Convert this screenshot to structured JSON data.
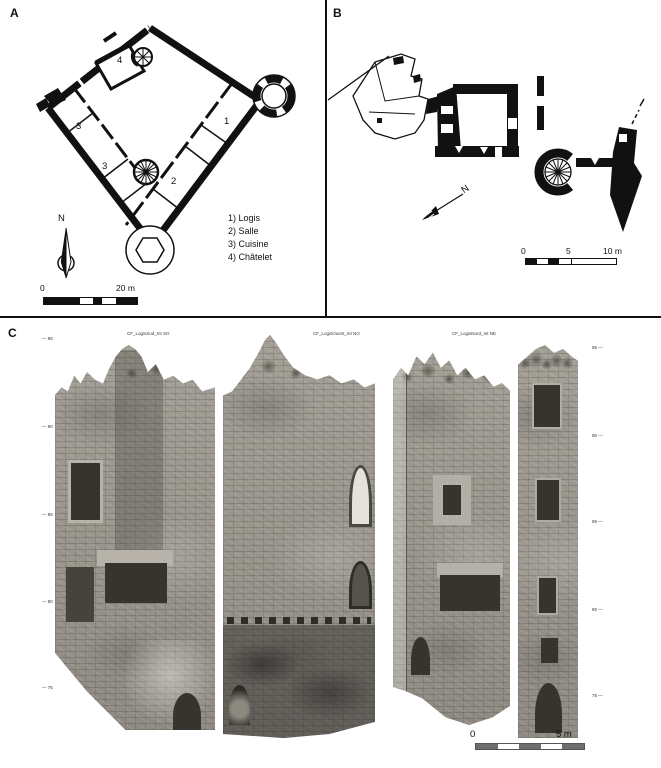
{
  "panel_a": {
    "label": "A",
    "north_label": "N",
    "room_numbers": {
      "logis": "1",
      "salle": "2",
      "cuisine_a": "3",
      "cuisine_b": "3",
      "chatelet": "4"
    },
    "legend": [
      "1) Logis",
      "2) Salle",
      "3) Cuisine",
      "4) Châtelet"
    ],
    "scale": {
      "start": "0",
      "end": "20 m"
    }
  },
  "panel_b": {
    "label": "B",
    "north_label": "N",
    "scale": {
      "start": "0",
      "mid": "5",
      "end": "10 m"
    }
  },
  "panel_c": {
    "label": "C",
    "photo_labels": [
      "CF_LogisSud_Int SO",
      "CF_LogisOuest_Int NO",
      "CF_LogisNord_Int NE"
    ],
    "elevations_left": [
      "— 95",
      "— 90",
      "— 85",
      "— 80",
      "— 75"
    ],
    "elevations_right": [
      "95 —",
      "90 —",
      "85 —",
      "80 —",
      "75 —"
    ],
    "scale": {
      "start": "0",
      "end": "5 m"
    }
  }
}
